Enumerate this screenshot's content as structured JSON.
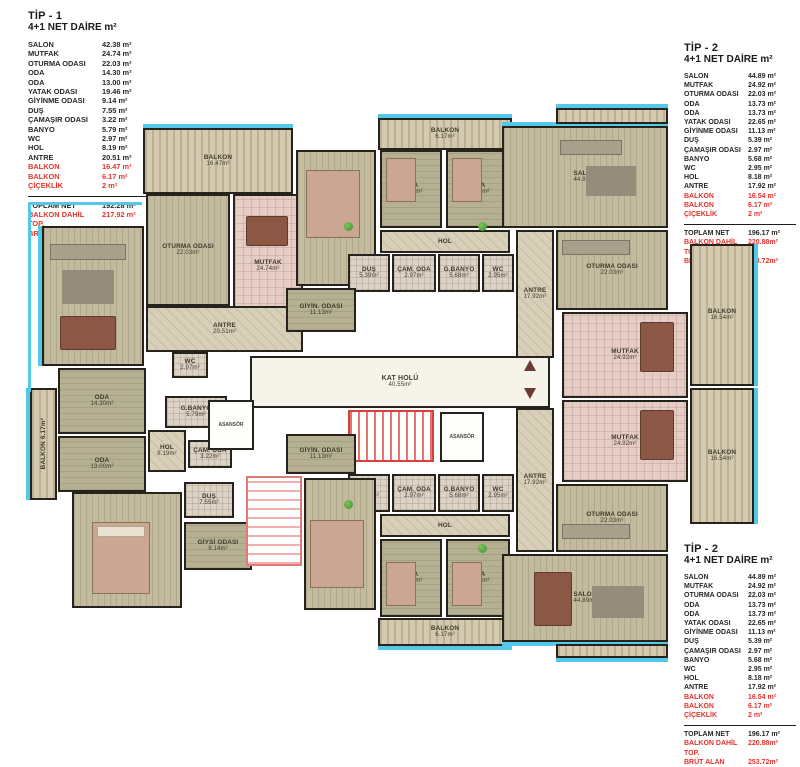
{
  "colors": {
    "red": "#e6332a",
    "cyan": "#54c8e8",
    "wall": "#26221c"
  },
  "legends": [
    {
      "title": "TİP - 1",
      "subtitle": "4+1 NET DAİRE m²",
      "rows": [
        {
          "label": "SALON",
          "value": "42.38 m²",
          "red": false
        },
        {
          "label": "MUTFAK",
          "value": "24.74 m²",
          "red": false
        },
        {
          "label": "OTURMA ODASI",
          "value": "22.03 m²",
          "red": false
        },
        {
          "label": "ODA",
          "value": "14.30 m²",
          "red": false
        },
        {
          "label": "ODA",
          "value": "13.00 m²",
          "red": false
        },
        {
          "label": "YATAK ODASI",
          "value": "19.46 m²",
          "red": false
        },
        {
          "label": "GİYİNME ODASI",
          "value": "9.14 m²",
          "red": false
        },
        {
          "label": "DUŞ",
          "value": "7.55 m²",
          "red": false
        },
        {
          "label": "ÇAMAŞIR ODASI",
          "value": "3.22 m²",
          "red": false
        },
        {
          "label": "BANYO",
          "value": "5.79 m²",
          "red": false
        },
        {
          "label": "WC",
          "value": "2.97 m²",
          "red": false
        },
        {
          "label": "HOL",
          "value": "8.19 m²",
          "red": false
        },
        {
          "label": "ANTRE",
          "value": "20.51 m²",
          "red": false
        },
        {
          "label": "BALKON",
          "value": "16.47 m²",
          "red": true
        },
        {
          "label": "BALKON",
          "value": "6.17 m²",
          "red": true
        },
        {
          "label": "ÇİÇEKLİK",
          "value": "2 m²",
          "red": true
        }
      ],
      "totals": [
        {
          "label": "TOPLAM NET",
          "value": "192.28 m²",
          "red": false
        },
        {
          "label": "BALKON DAHİL TOP.",
          "value": "217.92 m²",
          "red": true
        },
        {
          "label": "BRÜT ALAN",
          "value": "250.72m²",
          "red": true
        }
      ]
    },
    {
      "title": "TİP - 2",
      "subtitle": "4+1 NET DAİRE m²",
      "rows": [
        {
          "label": "SALON",
          "value": "44.89 m²",
          "red": false
        },
        {
          "label": "MUTFAK",
          "value": "24.92 m²",
          "red": false
        },
        {
          "label": "OTURMA ODASI",
          "value": "22.03 m²",
          "red": false
        },
        {
          "label": "ODA",
          "value": "13.73 m²",
          "red": false
        },
        {
          "label": "ODA",
          "value": "13.73 m²",
          "red": false
        },
        {
          "label": "YATAK ODASI",
          "value": "22.65 m²",
          "red": false
        },
        {
          "label": "GİYİNME ODASI",
          "value": "11.13 m²",
          "red": false
        },
        {
          "label": "DUŞ",
          "value": "5.39 m²",
          "red": false
        },
        {
          "label": "ÇAMAŞIR ODASI",
          "value": "2.97 m²",
          "red": false
        },
        {
          "label": "BANYO",
          "value": "5.68 m²",
          "red": false
        },
        {
          "label": "WC",
          "value": "2.95 m²",
          "red": false
        },
        {
          "label": "HOL",
          "value": "8.18 m²",
          "red": false
        },
        {
          "label": "ANTRE",
          "value": "17.92 m²",
          "red": false
        },
        {
          "label": "BALKON",
          "value": "16.54 m²",
          "red": true
        },
        {
          "label": "BALKON",
          "value": "6.17 m²",
          "red": true
        },
        {
          "label": "ÇİÇEKLİK",
          "value": "2 m²",
          "red": true
        }
      ],
      "totals": [
        {
          "label": "TOPLAM NET",
          "value": "196.17 m²",
          "red": false
        },
        {
          "label": "BALKON DAHİL TOP.",
          "value": "220.88m²",
          "red": true
        },
        {
          "label": "BRÜT ALAN",
          "value": "253.72m²",
          "red": true
        }
      ]
    },
    {
      "title": "TİP - 2",
      "subtitle": "4+1 NET DAİRE m²",
      "rows": [
        {
          "label": "SALON",
          "value": "44.89 m²",
          "red": false
        },
        {
          "label": "MUTFAK",
          "value": "24.92 m²",
          "red": false
        },
        {
          "label": "OTURMA ODASI",
          "value": "22.03 m²",
          "red": false
        },
        {
          "label": "ODA",
          "value": "13.73 m²",
          "red": false
        },
        {
          "label": "ODA",
          "value": "13.73 m²",
          "red": false
        },
        {
          "label": "YATAK ODASI",
          "value": "22.65 m²",
          "red": false
        },
        {
          "label": "GİYİNME ODASI",
          "value": "11.13 m²",
          "red": false
        },
        {
          "label": "DUŞ",
          "value": "5.39 m²",
          "red": false
        },
        {
          "label": "ÇAMAŞIR ODASI",
          "value": "2.97 m²",
          "red": false
        },
        {
          "label": "BANYO",
          "value": "5.68 m²",
          "red": false
        },
        {
          "label": "WC",
          "value": "2.95 m²",
          "red": false
        },
        {
          "label": "HOL",
          "value": "8.18 m²",
          "red": false
        },
        {
          "label": "ANTRE",
          "value": "17.92 m²",
          "red": false
        },
        {
          "label": "BALKON",
          "value": "16.54 m²",
          "red": true
        },
        {
          "label": "BALKON",
          "value": "6.17 m²",
          "red": true
        },
        {
          "label": "ÇİÇEKLİK",
          "value": "2 m²",
          "red": true
        }
      ],
      "totals": [
        {
          "label": "TOPLAM NET",
          "value": "196.17 m²",
          "red": false
        },
        {
          "label": "BALKON DAHİL TOP.",
          "value": "220.88m²",
          "red": true
        },
        {
          "label": "BRÜT ALAN",
          "value": "253.72m²",
          "red": true
        }
      ]
    }
  ],
  "plan": {
    "hall": {
      "label": "KAT HOLÜ",
      "area": "40.55m²"
    },
    "elevator_label": "ASANSÖR",
    "rooms": {
      "balkon1_t1": {
        "label": "BALKON",
        "area": "16.47m²"
      },
      "oturma_t1": {
        "label": "OTURMA ODASI",
        "area": "22.03m²"
      },
      "mutfak_t1": {
        "label": "MUTFAK",
        "area": "24.74m²"
      },
      "salon_t1": {
        "label": "SALON",
        "area": "42.38m²"
      },
      "antre_t1": {
        "label": "ANTRE",
        "area": "20.51m²"
      },
      "wc_t1": {
        "label": "WC",
        "area": "2.97m²"
      },
      "oda1_t1": {
        "label": "ODA",
        "area": "14.30m²"
      },
      "oda2_t1": {
        "label": "ODA",
        "area": "13.00m²"
      },
      "balkon2_t1": {
        "label": "BALKON 6.17m²",
        "area": ""
      },
      "gbanyo_t1": {
        "label": "G.BANYO",
        "area": "5.79m²"
      },
      "hol_t1": {
        "label": "HOL",
        "area": "8.19m²"
      },
      "cam_t1": {
        "label": "ÇAM. ODA",
        "area": "3.22m²"
      },
      "dus_t1": {
        "label": "DUŞ",
        "area": "7.55m²"
      },
      "yatak_t1": {
        "label": "YATAK ODASI",
        "area": "19.46m²"
      },
      "giysi_t1": {
        "label": "GİYSİ ODASI",
        "area": "9.14m²"
      },
      "balkon_t2t": {
        "label": "BALKON",
        "area": "6.17m²"
      },
      "yatak_t2t": {
        "label": "YATAK ODASI",
        "area": "22.65m²"
      },
      "oda1_t2t": {
        "label": "ODA",
        "area": "13.73m²"
      },
      "oda2_t2t": {
        "label": "ODA",
        "area": "13.73m²"
      },
      "hol_t2t": {
        "label": "HOL",
        "area": "8.18m²"
      },
      "dus_t2t": {
        "label": "DUŞ",
        "area": "5.39m²"
      },
      "cam_t2t": {
        "label": "ÇAM. ODA",
        "area": "2.97m²"
      },
      "gbanyo_t2t": {
        "label": "G.BANYO",
        "area": "5.68m²"
      },
      "wc_t2t": {
        "label": "WC",
        "area": "2.95m²"
      },
      "giyin_t2t": {
        "label": "GİYİN. ODASI",
        "area": "11.13m²"
      },
      "salon_t2t": {
        "label": "SALON",
        "area": "44.89m²"
      },
      "oturma_t2t": {
        "label": "OTURMA ODASI",
        "area": "22.03m²"
      },
      "antre_t2t": {
        "label": "ANTRE",
        "area": "17.92m²"
      },
      "mutfak_t2t": {
        "label": "MUTFAK",
        "area": "24.92m²"
      },
      "balkonR_t2t": {
        "label": "BALKON",
        "area": "16.54m²"
      },
      "balkon_t2b": {
        "label": "BALKON",
        "area": "6.17m²"
      },
      "yatak_t2b": {
        "label": "YATAK ODASI",
        "area": "22.65m²"
      },
      "oda1_t2b": {
        "label": "ODA",
        "area": "13.73m²"
      },
      "oda2_t2b": {
        "label": "ODA",
        "area": "13.73m²"
      },
      "hol_t2b": {
        "label": "HOL",
        "area": "8.18m²"
      },
      "dus_t2b": {
        "label": "DUŞ",
        "area": "5.39m²"
      },
      "cam_t2b": {
        "label": "ÇAM. ODA",
        "area": "2.97m²"
      },
      "gbanyo_t2b": {
        "label": "G.BANYO",
        "area": "5.68m²"
      },
      "wc_t2b": {
        "label": "WC",
        "area": "2.95m²"
      },
      "giyin_t2b": {
        "label": "GİYİN. ODASI",
        "area": "11.13m²"
      },
      "salon_t2b": {
        "label": "SALON",
        "area": "44.89m²"
      },
      "oturma_t2b": {
        "label": "OTURMA ODASI",
        "area": "22.03m²"
      },
      "antre_t2b": {
        "label": "ANTRE",
        "area": "17.92m²"
      },
      "mutfak_t2b": {
        "label": "MUTFAK",
        "area": "24.92m²"
      },
      "balkonR_t2b": {
        "label": "BALKON",
        "area": "16.54m²"
      }
    }
  }
}
